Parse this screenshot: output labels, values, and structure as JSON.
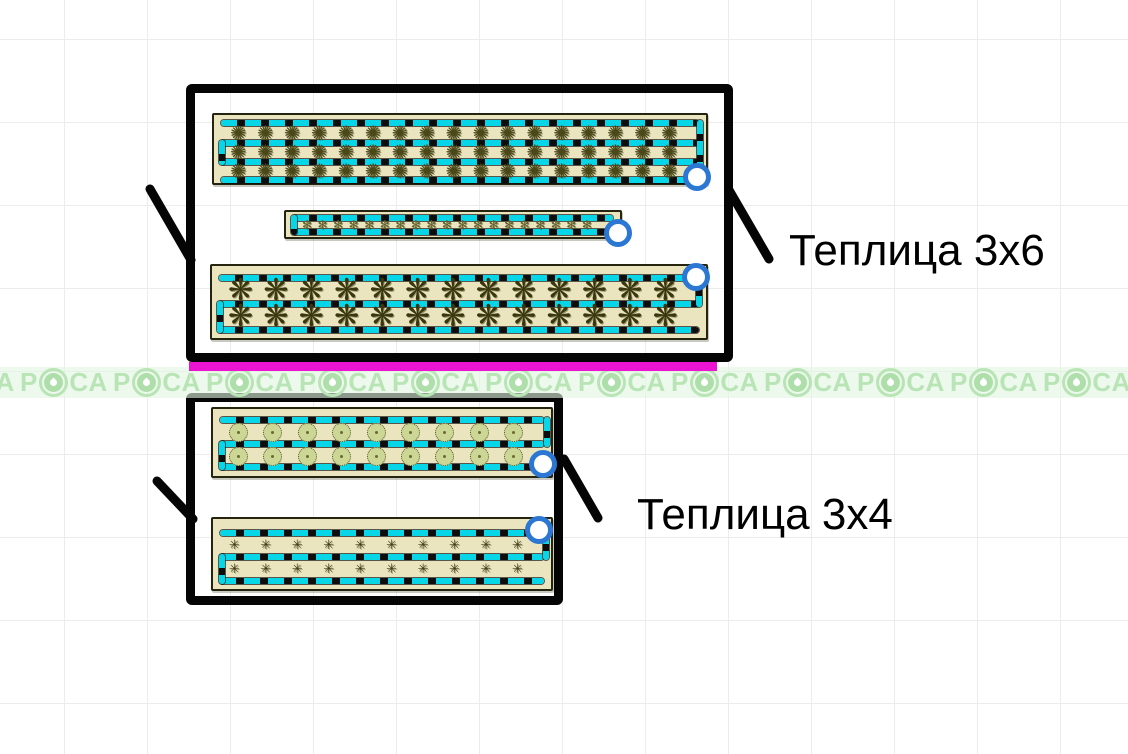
{
  "app": {
    "canvas_name": "garden-plan-canvas"
  },
  "labels": {
    "greenhouse_top": "Теплица 3x6",
    "greenhouse_bottom": "Теплица 3x4"
  },
  "watermark": {
    "prefix": "Р",
    "suffix": "СА",
    "full_text": "РОСА",
    "repeat_count": 13,
    "band": {
      "x": -73,
      "y": 367,
      "h": 31,
      "period": 93
    }
  },
  "colors": {
    "cyan_drip": "#07d6e8",
    "magenta": "#ea14d2",
    "handle_blue": "#2b77d3",
    "bed_fill": "#eae5bf",
    "bed_border": "#25240e",
    "watermark_green": "#b9e5b6",
    "watermark_core": "#aedfab",
    "watermark_bg": "rgba(225,246,224,0.62)",
    "grid_line": "#ececec"
  },
  "plant_glyphs": {
    "mottled": {
      "char": "✺",
      "color": "#4a4719"
    },
    "scribble-small": {
      "char": "✻",
      "color": "#63602a"
    },
    "spiky-large": {
      "char": "❋",
      "color": "#3a370f"
    },
    "spiky-small": {
      "char": "✳",
      "color": "#403d12"
    },
    "circle": {
      "char": "",
      "color": "#ccd795"
    }
  },
  "scene": {
    "magenta_line": {
      "x": 189,
      "y": 362,
      "w": 528,
      "h": 9
    },
    "annotations": [
      {
        "text": "Теплица 3x6",
        "x": 789,
        "y": 226
      },
      {
        "text": "Теплица 3x4",
        "x": 637,
        "y": 490
      }
    ],
    "leader_lines": [
      {
        "x1": 150,
        "y1": 189,
        "x2": 191,
        "y2": 260
      },
      {
        "x1": 729,
        "y1": 190,
        "x2": 769,
        "y2": 259
      },
      {
        "x1": 157,
        "y1": 481,
        "x2": 193,
        "y2": 519
      },
      {
        "x1": 564,
        "y1": 459,
        "x2": 598,
        "y2": 518
      }
    ],
    "greenhouses": [
      {
        "name": "greenhouse-3x6",
        "box": {
          "x": 186,
          "y": 84,
          "w": 547,
          "h": 278
        },
        "beds": [
          {
            "x": 212,
            "y": 113,
            "w": 496,
            "h": 72,
            "lines": [
              8,
              28,
              47,
              65
            ],
            "connectors": [
              {
                "side": "right",
                "x": 483,
                "y1": 8,
                "y2": 65
              },
              {
                "side": "left",
                "x": 5,
                "y1": 28,
                "y2": 47
              }
            ],
            "rows": [
              {
                "cy": 18,
                "count": 17,
                "type": "mottled",
                "size": 20
              },
              {
                "cy": 37,
                "count": 17,
                "type": "mottled",
                "size": 20
              },
              {
                "cy": 56,
                "count": 17,
                "type": "mottled",
                "size": 20
              }
            ],
            "handle": {
              "x": 697,
              "y": 177
            }
          },
          {
            "x": 284,
            "y": 210,
            "w": 338,
            "h": 29,
            "lines": [
              6,
              20
            ],
            "connectors": [
              {
                "side": "left",
                "x": 5,
                "y1": 6,
                "y2": 20
              }
            ],
            "rows": [
              {
                "cy": 13,
                "count": 19,
                "type": "scribble-small",
                "size": 12
              }
            ],
            "handle": {
              "x": 618,
              "y": 233
            }
          },
          {
            "x": 210,
            "y": 264,
            "w": 498,
            "h": 76,
            "lines": [
              12,
              38,
              64
            ],
            "connectors": [
              {
                "side": "right",
                "x": 484,
                "y1": 12,
                "y2": 38
              },
              {
                "side": "left",
                "x": 5,
                "y1": 38,
                "y2": 64
              }
            ],
            "rows": [
              {
                "cy": 25,
                "count": 13,
                "type": "spiky-large",
                "size": 30
              },
              {
                "cy": 51,
                "count": 13,
                "type": "spiky-large",
                "size": 30
              }
            ],
            "handle": {
              "x": 696,
              "y": 277
            }
          }
        ]
      },
      {
        "name": "greenhouse-3x4",
        "box": {
          "x": 186,
          "y": 393,
          "w": 377,
          "h": 212
        },
        "beds": [
          {
            "x": 211,
            "y": 407,
            "w": 342,
            "h": 71,
            "lines": [
              11,
              35,
              58
            ],
            "connectors": [
              {
                "side": "right",
                "x": 331,
                "y1": 11,
                "y2": 35
              },
              {
                "side": "left",
                "x": 6,
                "y1": 35,
                "y2": 58
              }
            ],
            "rows": [
              {
                "cy": 23,
                "count": 9,
                "type": "circle",
                "size": 19
              },
              {
                "cy": 47,
                "count": 9,
                "type": "circle",
                "size": 19
              }
            ],
            "handle": {
              "x": 543,
              "y": 464
            }
          },
          {
            "x": 211,
            "y": 517,
            "w": 342,
            "h": 74,
            "lines": [
              14,
              38,
              62
            ],
            "connectors": [
              {
                "side": "right",
                "x": 330,
                "y1": 14,
                "y2": 38
              },
              {
                "side": "left",
                "x": 6,
                "y1": 38,
                "y2": 62
              }
            ],
            "rows": [
              {
                "cy": 26,
                "count": 10,
                "type": "spiky-small",
                "size": 13
              },
              {
                "cy": 50,
                "count": 10,
                "type": "spiky-small",
                "size": 13
              }
            ],
            "handle": {
              "x": 539,
              "y": 530
            }
          }
        ]
      }
    ]
  }
}
